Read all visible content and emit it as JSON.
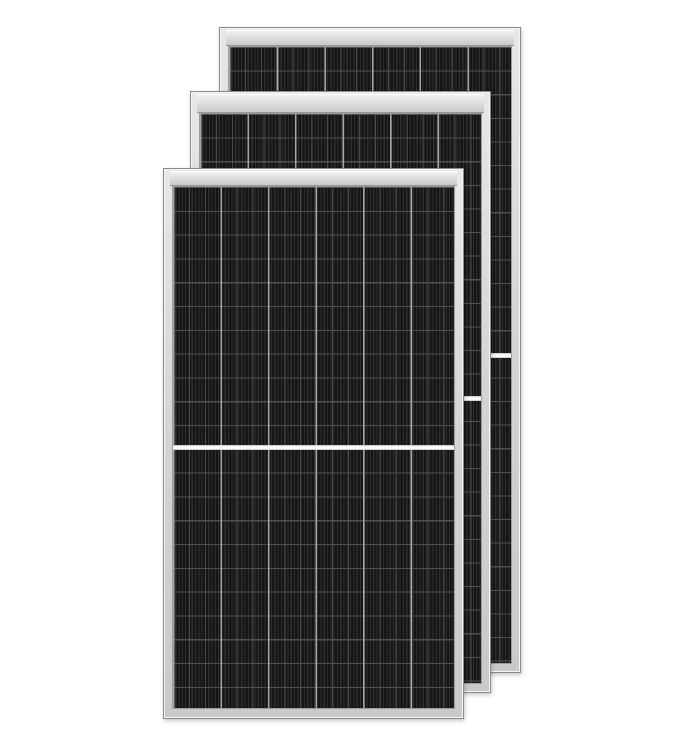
{
  "scene": {
    "description": "Product render of three overlapping black half-cut monocrystalline solar panels with silver aluminium frames, fanned from back-right to front-left on a plain white background",
    "background_color": "#ffffff",
    "panel_count": 3,
    "cell_columns_per_panel": 6,
    "half_cell_divider": true
  },
  "colors": {
    "background": "#ffffff",
    "frame": "#d6d6d6",
    "frame_border": "#8a8a8a",
    "frame_highlight": "#f5f5f5",
    "cells_border": "#9c9c9c",
    "cell_base": "#1d1d1d",
    "cell_stripe_dark": "#151515",
    "cell_stripe_light": "#2e2e2e",
    "cell_accent": "#4a4a4a",
    "row_line": "#505050",
    "column_gap": "#a6a6a6",
    "divider": "#fbfbfb"
  },
  "panels": [
    {
      "name": "back",
      "style": {
        "left": "219px",
        "top": "27px",
        "width": "302px",
        "height": "646px",
        "z-index": "1",
        "--band": "15px",
        "--cells-top": "18px",
        "--cells-bottom": "8px",
        "--cells-side": "8px",
        "--col": "47.66px",
        "--row": "23.6px"
      }
    },
    {
      "name": "middle",
      "style": {
        "left": "190px",
        "top": "91px",
        "width": "301px",
        "height": "602px",
        "z-index": "2",
        "--band": "18px",
        "--cells-top": "21px",
        "--cells-bottom": "8px",
        "--cells-side": "8px",
        "--col": "47.5px",
        "--row": "23.6px"
      }
    },
    {
      "name": "front",
      "style": {
        "left": "163px",
        "top": "168px",
        "width": "301px",
        "height": "551px",
        "z-index": "3",
        "--band": "14px",
        "--cells-top": "17px",
        "--cells-bottom": "9px",
        "--cells-side": "8px",
        "--col": "47.5px",
        "--row": "23.8px"
      }
    }
  ]
}
